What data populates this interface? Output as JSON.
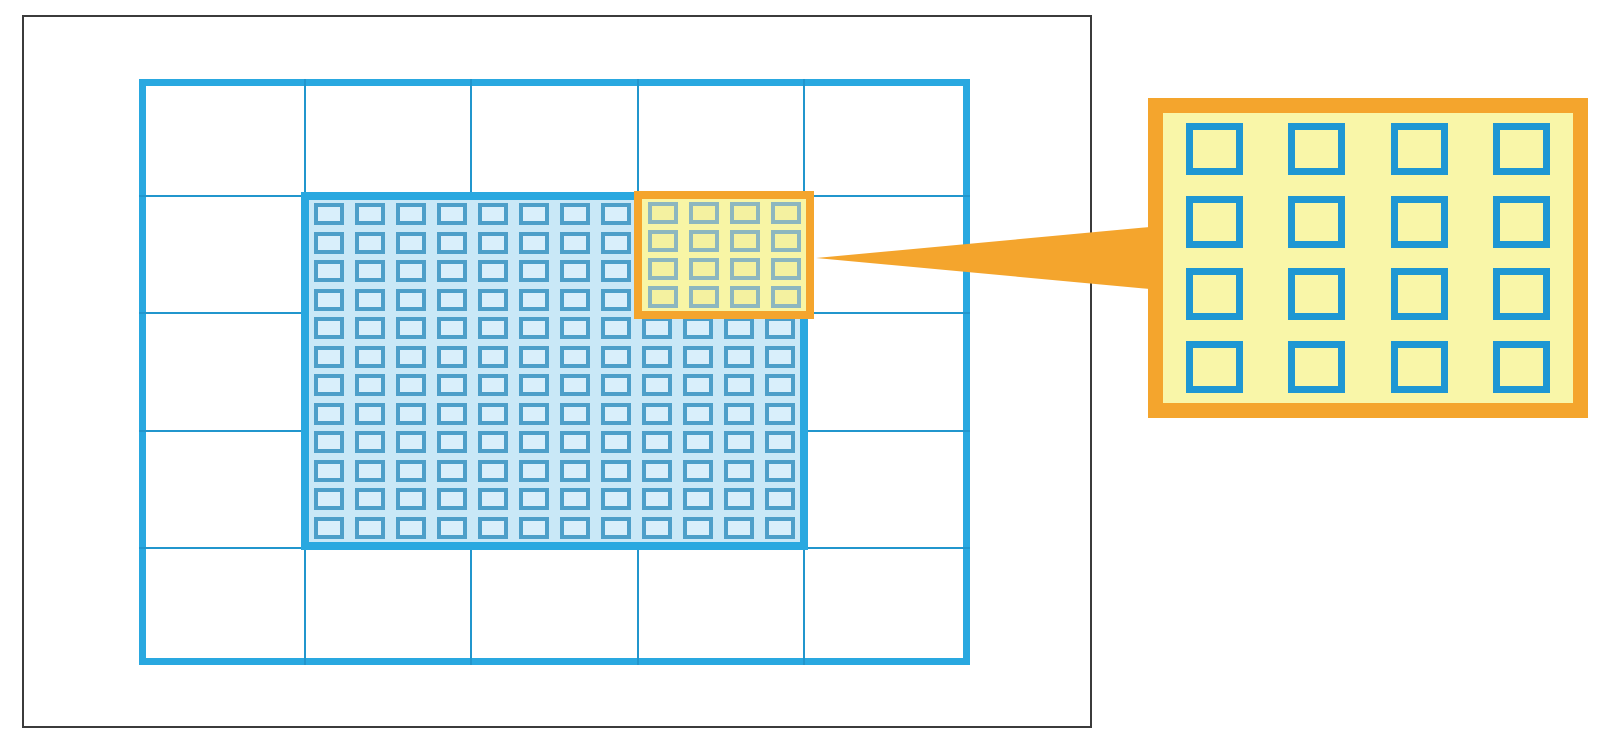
{
  "diagram": {
    "name": "nested-grid-zoom-callout",
    "description": "Coarse 5x5 grid with shaded fine-grid region, highlighted 4x4 block and magnified callout panel",
    "colors": {
      "background": "#ffffff",
      "frame": "#3b3b3b",
      "grid_blue": "#29a8e0",
      "line_blue": "#2196cd",
      "inner_bg": "#c9e8f7",
      "fine_square_border": "#4d9fc9",
      "fine_square_fill": "#d9effb",
      "orange": "#f4a52d",
      "yellow_bg": "#f8f5a5",
      "highlight_square_border": "#8db7bf",
      "highlight_square_fill": "#f4f1a0",
      "callout_bg": "#f9f6a8",
      "callout_square_border": "#1f97d3",
      "callout_square_fill": "#f9f6a8"
    },
    "main_grid": {
      "cols": 5,
      "rows": 5
    },
    "fine_grid": {
      "cols": 12,
      "rows": 12
    },
    "highlight_block": {
      "cols": 4,
      "rows": 4
    },
    "callout_panel": {
      "cols": 4,
      "rows": 4
    }
  }
}
